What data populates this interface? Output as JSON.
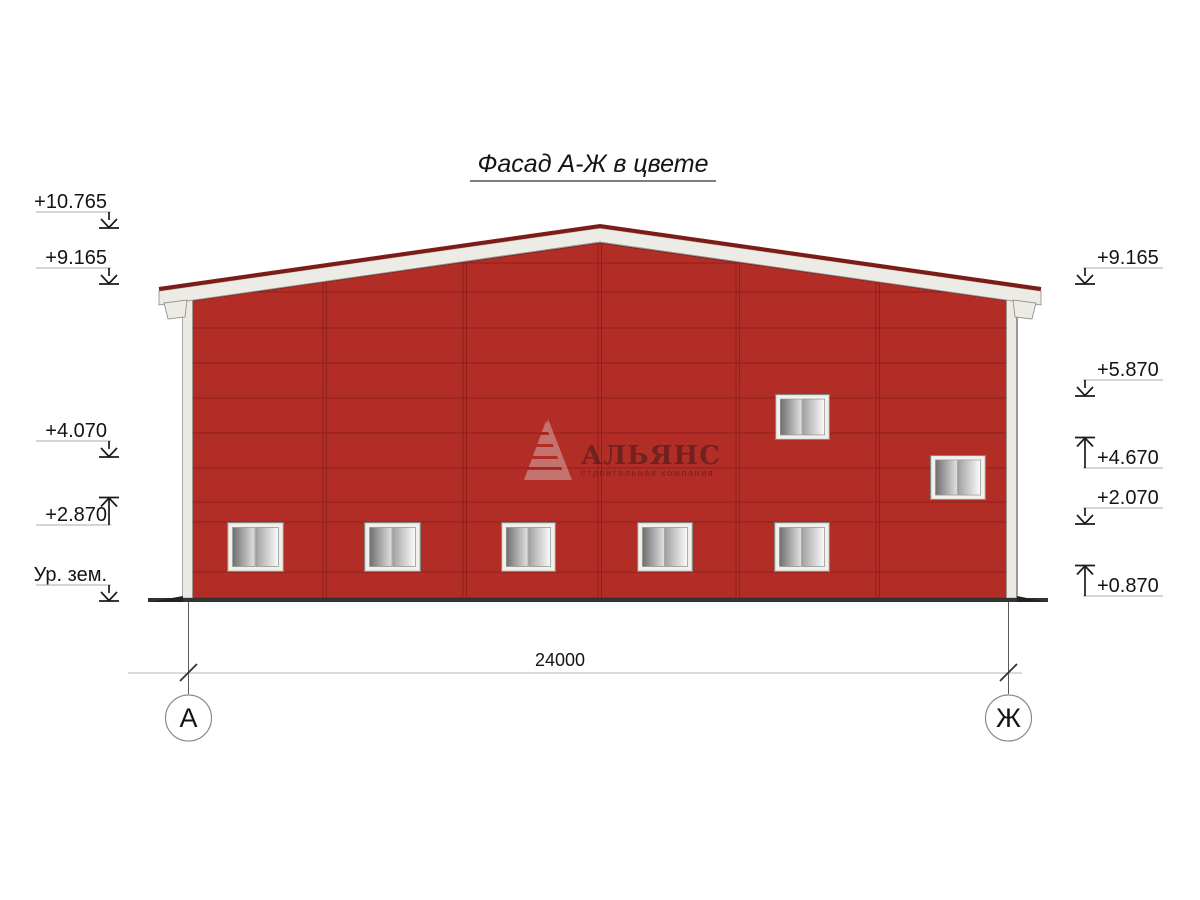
{
  "title": {
    "text": "Фасад А-Ж в цвете"
  },
  "elevation_marks": {
    "left": [
      {
        "label": "+10.765",
        "direction": "down"
      },
      {
        "label": "+9.165",
        "direction": "down"
      },
      {
        "label": "+4.070",
        "direction": "down"
      },
      {
        "label": "+2.870",
        "direction": "up"
      },
      {
        "label": "Ур. зем.",
        "direction": "down"
      }
    ],
    "right": [
      {
        "label": "+9.165",
        "direction": "down"
      },
      {
        "label": "+5.870",
        "direction": "down"
      },
      {
        "label": "+4.670",
        "direction": "up"
      },
      {
        "label": "+2.070",
        "direction": "down"
      },
      {
        "label": "+0.870",
        "direction": "up"
      }
    ]
  },
  "dimension": {
    "length_label": "24000"
  },
  "axis_markers": {
    "left": "А",
    "right": "Ж"
  },
  "watermark": {
    "company": "АЛЬЯНС",
    "tagline": "строительная компания"
  },
  "colors": {
    "facade_red": "#B32D27",
    "panel_line_red": "#871E1A",
    "ridge_cap_red": "#7D1B17",
    "fascia_white": "#ECEBE5",
    "trim_white": "#EAE9E3",
    "ground_dark": "#333333"
  }
}
